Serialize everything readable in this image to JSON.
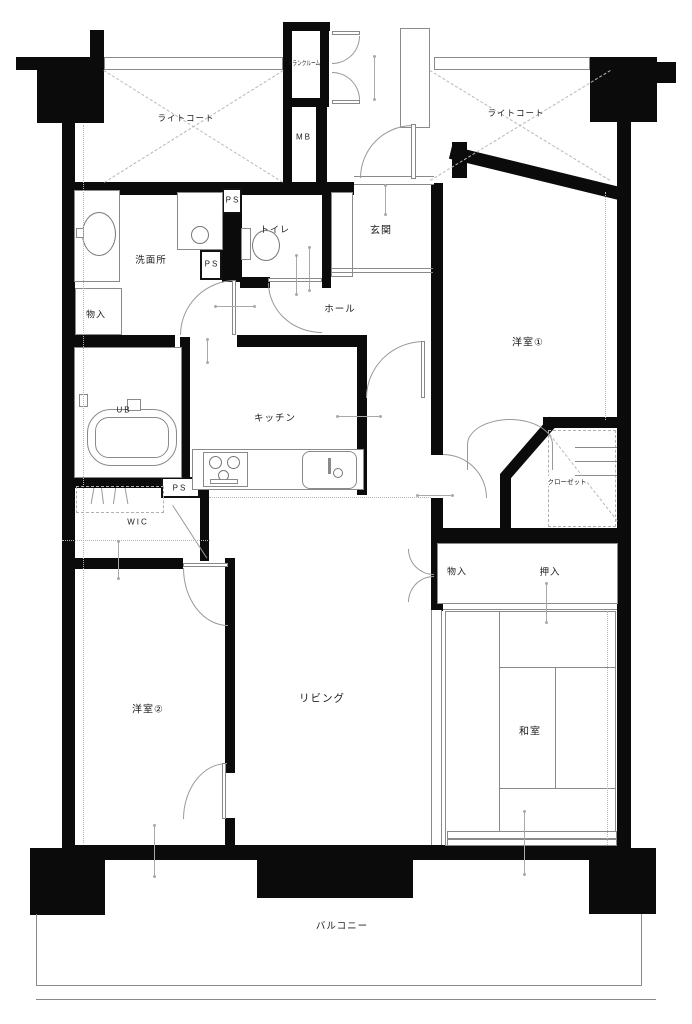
{
  "labels": {
    "light_court_left": "ライトコート",
    "light_court_right": "ライトコート",
    "trunk_room": "トランクルーム",
    "meter_box": "MB",
    "ps": "PS",
    "toilet": "トイレ",
    "washroom": "洗面所",
    "storage_top": "物入",
    "hall": "ホール",
    "entrance": "玄関",
    "western_room_1": "洋室①",
    "closet": "クローゼット",
    "unit_bath": "UB",
    "kitchen": "キッチン",
    "wic": "WIC",
    "storage_mid": "物入",
    "oshiire": "押入",
    "western_room_2": "洋室②",
    "living": "リビング",
    "japanese_room": "和室",
    "balcony": "バルコニー"
  },
  "colors": {
    "wall": "#0b0b0b",
    "thin_line": "#8a8a8a",
    "text": "#1c1c1c"
  }
}
